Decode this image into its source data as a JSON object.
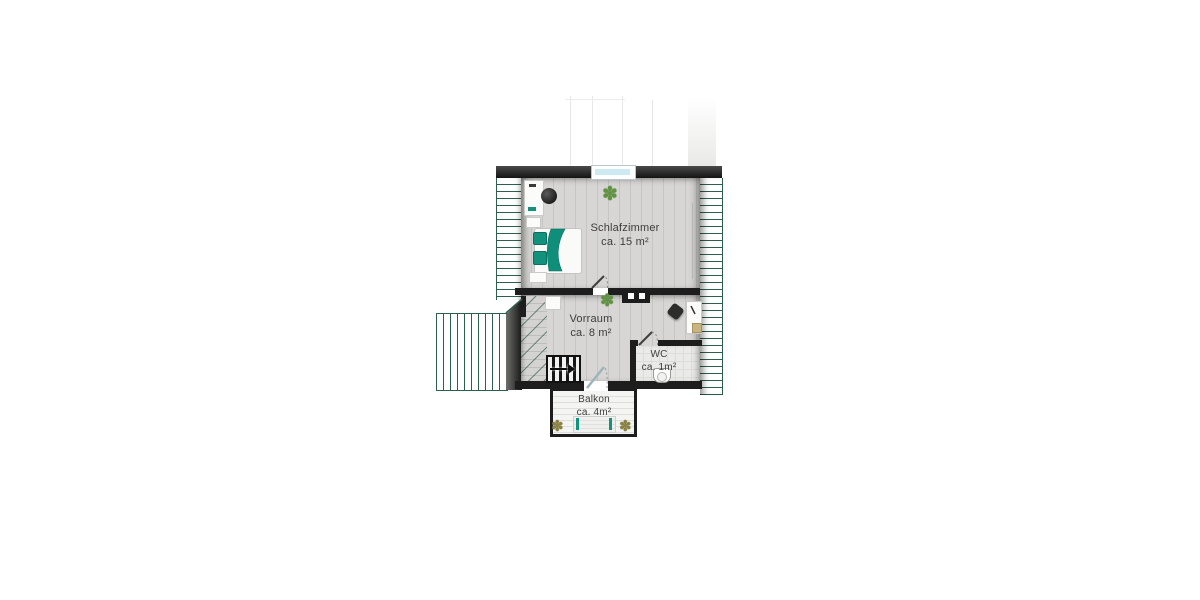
{
  "plan": {
    "rooms": [
      {
        "id": "schlafzimmer",
        "name": "Schlafzimmer",
        "area": "ca. 15 m²"
      },
      {
        "id": "vorraum",
        "name": "Vorraum",
        "area": "ca. 8 m²"
      },
      {
        "id": "wc",
        "name": "WC",
        "area": "ca. 1m²"
      },
      {
        "id": "balkon",
        "name": "Balkon",
        "area": "ca. 4m²"
      }
    ],
    "colors": {
      "roof_hatch_green": "#2e5e4e",
      "wall_dark": "#1c1c1c",
      "floor_wood": "#d7d6d4",
      "accent_teal": "#12917c",
      "window_glass": "#cde9f2",
      "label_text": "#3d3d3d",
      "balcony_floor": "#f4f4f2"
    },
    "icons": {
      "plant": "✽"
    }
  }
}
